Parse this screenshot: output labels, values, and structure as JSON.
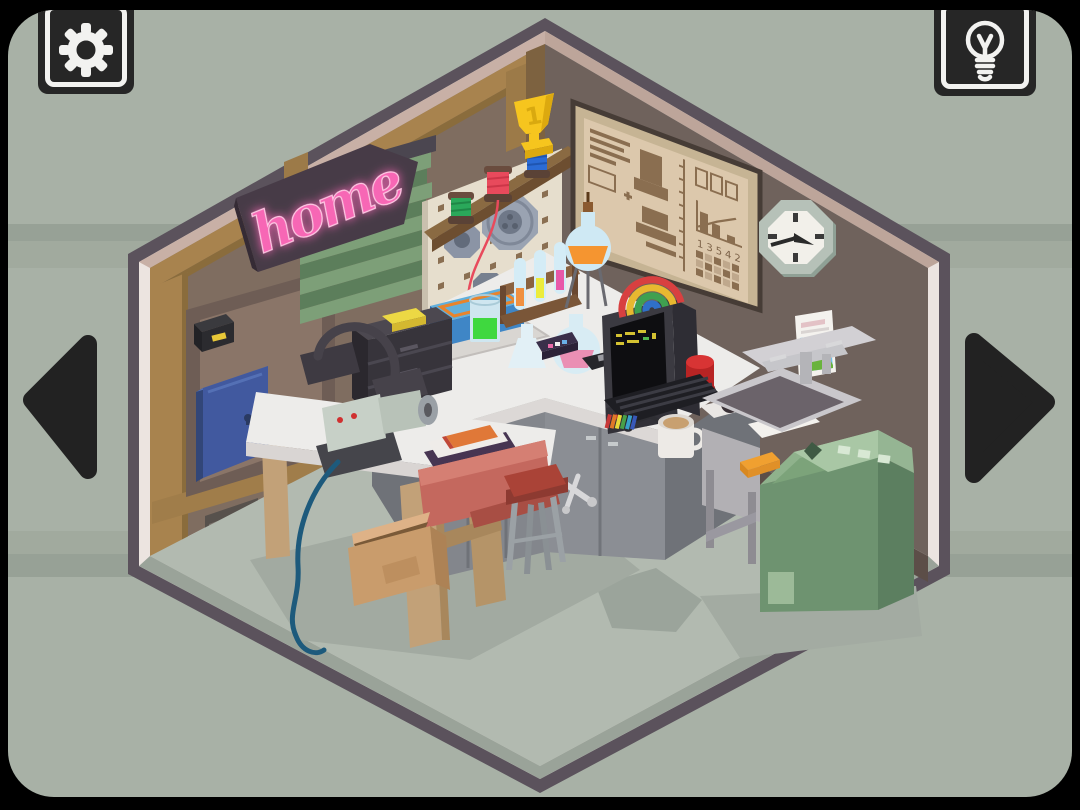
{
  "screen": {
    "type": "isometric room escape game",
    "view": "workshop corner room"
  },
  "toolbar": {
    "settings_button": {
      "icon": "gear"
    },
    "hint_button": {
      "icon": "lightbulb"
    }
  },
  "navigation": {
    "prev_button": {
      "icon": "arrow-left"
    },
    "next_button": {
      "icon": "arrow-right"
    }
  },
  "room": {
    "neon_sign": {
      "text": "home",
      "color": "#f767b5"
    },
    "trophy": {
      "label": "1",
      "color": "#f6c51e"
    },
    "blueprint_board": {
      "grid_numbers": "13542"
    },
    "objects": [
      "neon-home-sign",
      "window-blinds",
      "matchbox",
      "breaker-box",
      "wall-vent",
      "pegboard",
      "saw-blades",
      "thread-spool-green",
      "thread-spool-red",
      "thread-spool-blue",
      "trophy",
      "blueprint-board",
      "wall-clock",
      "poster",
      "desk-lamp",
      "drawer-unit",
      "yellow-sponge",
      "bench-grinder",
      "power-cable",
      "magazine",
      "pen",
      "bench-vise",
      "stool",
      "cardboard-box",
      "storage-box",
      "tray",
      "beaker-green",
      "test-tube-rack",
      "erlenmeyer-flask",
      "tripod-flask",
      "round-flask-pink",
      "cassette",
      "floppy-disk",
      "jar",
      "crt-monitor",
      "rainbow-binders",
      "red-button",
      "scissors",
      "tape-box",
      "papers",
      "keyboard",
      "coffee-mug",
      "sink",
      "faucet",
      "washing-machine",
      "orange-sponge"
    ]
  },
  "palette": {
    "frame": "#000000",
    "background": "#a8b1a6",
    "stripe_dark": "#97a196",
    "stripe_mid": "#a1aa9e",
    "room_border": "#5b525c",
    "room_border_inner": "#ece4e0",
    "wall_top_edge": "#c8b0a6",
    "left_wall": "#7f6d60",
    "right_wall": "#6f625c",
    "wood": "#a8834e",
    "floor": "#b2bab0",
    "neon_pink": "#f767b5",
    "blinds_green": "#7d9f78",
    "cabinet_blue": "#41599f",
    "counter_top": "#edecea",
    "cabinet_gray": "#8b8e94",
    "washer_green": "#6e9370",
    "vise_red": "#c4685e",
    "stool_red": "#aa4337",
    "trophy_gold": "#f6c51e",
    "blueprint_paper": "#dcc8ac",
    "blueprint_ink": "#8a6e50"
  }
}
